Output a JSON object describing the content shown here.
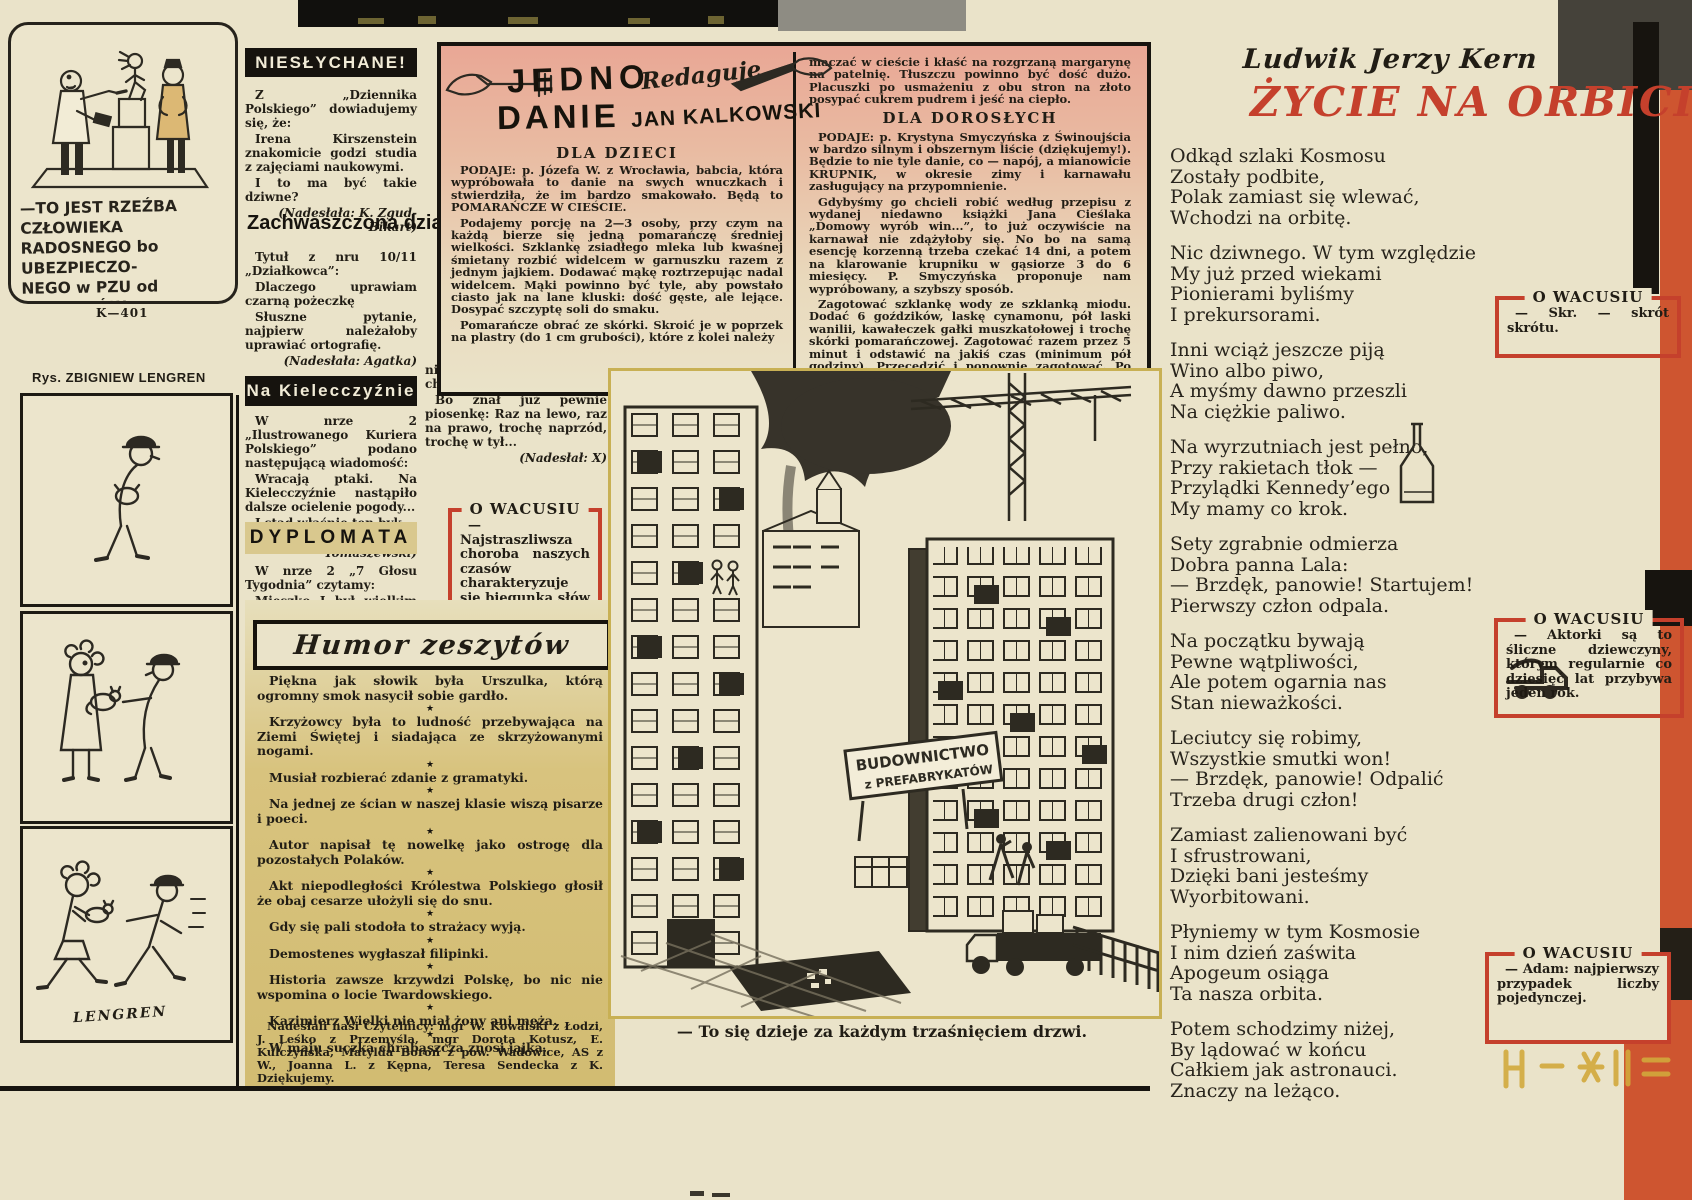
{
  "pzu": {
    "caption": [
      "—TO JEST RZEŹBA CZŁOWIEKA",
      "RADOSNEGO bo UBEZPIECZO-",
      "NEGO w PZU od WYPADKÓW",
      "NIESZCZĘŚLIWYCH"
    ],
    "code": "K—401"
  },
  "lengren": {
    "byline": "Rys. ZBIGNIEW LENGREN",
    "signature": "LENGREN"
  },
  "nieslychane": {
    "title": "NIESŁYCHANE!",
    "p1": "Z „Dziennika Polskiego” dowiadujemy się, że:",
    "p2": "Irena Kirszenstein znakomicie godzi studia z zajęciami naukowymi.",
    "p3": "I to ma być takie dziwne?",
    "credit": "(Nadesłała: K. Zgud-Bikart)"
  },
  "zachwaszczona": {
    "title": "Zachwaszczona działka",
    "p1": "Tytuł z nru 10/11 „Działkowca”:",
    "p2": "Dlaczego uprawiam czarną pożeczkę",
    "p3": "Słuszne pytanie, najpierw należałoby uprawiać ortografię.",
    "credit": "(Nadesłała: Agatka)"
  },
  "kielecczyzna": {
    "title": "Na Kielecczyźnie",
    "p1": "W nrze 2 „Ilustrowanego Kuriera Polskiego” podano następującą wiadomość:",
    "p2": "Wracają ptaki. Na Kielecczyźnie nastąpiło dalsze ocielenie pogody...",
    "p3": "I stąd właśnie ten byk.",
    "credit": "(Nadesłał: S. Tomaszewski)"
  },
  "dyplomata": {
    "title": "DYPLOMATA",
    "p1": "W nrze 2 „7 Głosu Tygodnia” czytamy:",
    "p2": "Mieszko I był wielkim mężem stanu, umiejącym",
    "cont1": "nie tylko iść naprzód, ale i chwilowo się cofać.",
    "cont2": "Bo znał już pewnie piosenkę: Raz na lewo, raz na prawo, trochę naprzód, trochę w tył...",
    "credit": "(Nadesłał: X)"
  },
  "wacusiu_mid": {
    "title": "O WACUSIU",
    "text": "— Najstraszliwsza choroba naszych czasów charakteryzuje się biegunką słów przy jednoczesnej obstrukcji myśli."
  },
  "humor": {
    "title": "Humor zeszytów",
    "sep": "★",
    "items": [
      "Piękna jak słowik była Urszulka, którą ogromny smok nasycił sobie gardło.",
      "Krzyżowcy była to ludność przebywająca na Ziemi Świętej i siadająca ze skrzyżowanymi nogami.",
      "Musiał rozbierać zdanie z gramatyki.",
      "Na jednej ze ścian w naszej klasie wiszą pisarze i poeci.",
      "Autor napisał tę nowelkę jako ostrogę dla pozostałych Polaków.",
      "Akt niepodległości Królestwa Polskiego głosił że obaj cesarze ułożyli się do snu.",
      "Gdy się pali stodoła to strażacy wyją.",
      "Demostenes wygłaszał filipinki.",
      "Historia zawsze krzywdzi Polskę, bo nic nie wspomina o locie Twardowskiego.",
      "Kazimierz Wielki nie miał żony ani męża.",
      "W maju suczka chrabąszcza znosi jajka."
    ],
    "footer": "Nadesłali nasi Czytelnicy: mgr W. Kowalski z Łodzi, J. Leśko z Przemyśla, mgr Dorota Kotusz, E. Kulczyńska, Matylda Boroń z pow. Wadowice, AS z W., Joanna L. z Kępna, Teresa Sendecka z K. Dziękujemy."
  },
  "recipe": {
    "title_word1": "JEDNO",
    "title_word2": "DANIE",
    "redaguje": "Redaguje",
    "editor": "JAN KALKOWSKI",
    "dzieci": {
      "heading": "DLA DZIECI",
      "p1": "PODAJE: p. Józefa W. z Wrocławia, babcia, która wypróbowała to danie na swych wnuczkach i stwierdziła, że im bardzo smakowało. Będą to POMARAŃCZE W CIEŚCIE.",
      "p2": "Podajemy porcję na 2—3 osoby, przy czym na każdą bierze się jedną pomarańczę średniej wielkości. Szklankę zsiadłego mleka lub kwaśnej śmietany rozbić widelcem w garnuszku razem z jednym jajkiem. Dodawać mąkę roztrzepując nadal widelcem. Mąki powinno być tyle, aby powstało ciasto jak na lane kluski: dość gęste, ale lejące. Dosypać szczyptę soli do smaku.",
      "p3": "Pomarańcze obrać ze skórki. Skroić je w poprzek na plastry (do 1 cm grubości), które z kolei należy"
    },
    "dorosli": {
      "cont": "maczać w cieście i kłaść na rozgrzaną margarynę na patelnię. Tłuszczu powinno być dość dużo. Placuszki po usmażeniu z obu stron na złoto posypać cukrem pudrem i jeść na ciepło.",
      "heading": "DLA DOROSŁYCH",
      "p1": "PODAJE: p. Krystyna Smyczyńska z Świnoujścia w bardzo silnym i obszernym liście (dziękujemy!). Będzie to nie tyle danie, co — napój, a mianowicie KRUPNIK, w okresie zimy i karnawału zasługujący na przypomnienie.",
      "p2": "Gdybyśmy go chcieli robić według przepisu z wydanej niedawno książki Jana Cieślaka „Domowy wyrób win...”, to już oczywiście na karnawał nie zdążyłoby się. No bo na samą esencję korzenną trzeba czekać 14 dni, a potem na klarowanie krupniku w gąsiorze 3 do 6 miesięcy. P. Smyczyńska proponuje nam wypróbowany, a szybszy sposób.",
      "p3": "Zagotować szklankę wody ze szklanką miodu. Dodać 6 goździków, laskę cynamonu, pół laski wanilii, kawałeczek gałki muszkatołowej i trochę skórki pomarańczowej. Zagotować razem przez 5 minut i odstawić na jakiś czas (minimum pół godziny). Przecedzić i ponownie zagotować. Po zdjęciu z ognia dolać ½ l. spirytusu. Zamieszać. Pić na gorąco, małymi łyczkami z glinianych kieliszeczków lub małych filiżanek do kawy. Jest to napój do smakowania, a nie zalewania się!"
    }
  },
  "illustration": {
    "sign_line1": "BUDOWNICTWO",
    "sign_line2": "z PREFABRYKATÓW",
    "caption": "— To się dzieje za każdym trzaśnięciem drzwi."
  },
  "kern": {
    "byline": "Ludwik Jerzy Kern",
    "title": "ŻYCIE NA ORBICIE",
    "stanzas": [
      [
        "Odkąd szlaki Kosmosu",
        "Zostały podbite,",
        "Polak zamiast się wlewać,",
        "Wchodzi na orbitę."
      ],
      [
        "Nic dziwnego. W tym względzie",
        "My już przed wiekami",
        "Pionierami byliśmy",
        "I prekursorami."
      ],
      [
        "Inni wciąż jeszcze piją",
        "Wino albo piwo,",
        "A myśmy dawno przeszli",
        "Na ciężkie paliwo."
      ],
      [
        "Na wyrzutniach jest pełno,",
        "Przy rakietach tłok —",
        "Przylądki Kennedy’ego",
        "My mamy co krok."
      ],
      [
        "Sety zgrabnie odmierza",
        "Dobra panna Lala:",
        "— Brzdęk, panowie! Startujem!",
        "Pierwszy człon odpala."
      ],
      [
        "Na początku bywają",
        "Pewne wątpliwości,",
        "Ale potem ogarnia nas",
        "Stan nieważkości."
      ],
      [
        "Leciutcy się robimy,",
        "Wszystkie smutki won!",
        "— Brzdęk, panowie! Odpalić",
        "Trzeba drugi człon!"
      ],
      [
        "Zamiast zalienowani być",
        "I sfrustrowani,",
        "Dzięki bani jesteśmy",
        "Wyorbitowani."
      ],
      [
        "Płyniemy w tym Kosmosie",
        "I nim dzień zaświta",
        "Apogeum osiąga",
        "Ta nasza orbita."
      ],
      [
        "Potem schodzimy niżej,",
        "By lądować w końcu",
        "Całkiem jak astronauci.",
        "Znaczy na leżąco."
      ]
    ]
  },
  "wacusiu_boxes": [
    {
      "title": "O WACUSIU",
      "text": "— Skr. — skrót skrótu."
    },
    {
      "title": "O WACUSIU",
      "text": "— Aktorki są to śliczne dziewczyny, którym regularnie co dziesięć lat przybywa jeden rok."
    },
    {
      "title": "O WACUSIU",
      "text": "— Adam: najpierwszy przypadek liczby pojedynczej."
    }
  ],
  "colors": {
    "accent_red": "#c5402c",
    "orange_band": "#ce5530",
    "khaki": "#d8c37e",
    "ink": "#211d15"
  }
}
